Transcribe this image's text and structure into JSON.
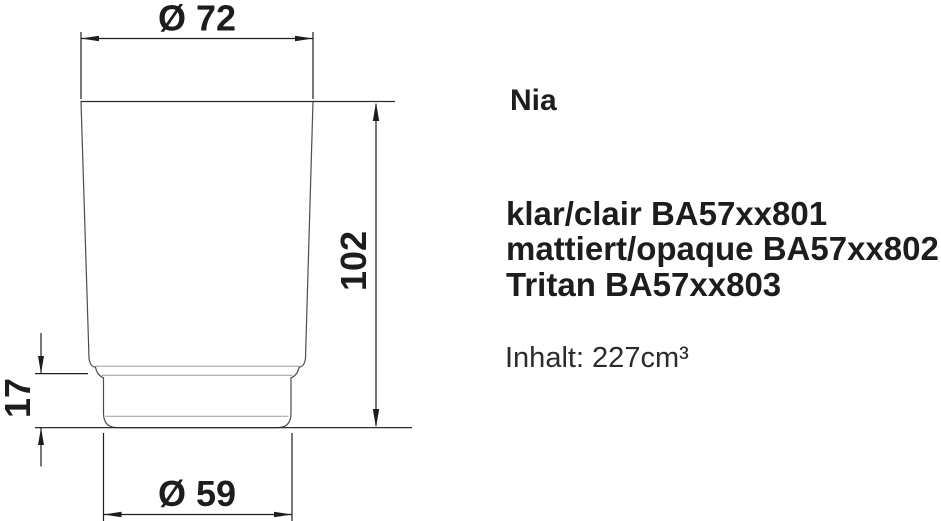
{
  "product": {
    "name": "Nia",
    "variants": [
      {
        "label": "klar/clair BA57xx801"
      },
      {
        "label": "mattiert/opaque BA57xx802"
      },
      {
        "label": "Tritan BA57xx803"
      }
    ],
    "capacity": "Inhalt: 227cm³"
  },
  "drawing": {
    "type": "technical-drawing",
    "subject": "tumbler-glass-side-profile",
    "dimensions": {
      "top_diameter": "Ø 72",
      "height": "102",
      "base_height": "17",
      "base_diameter": "Ø 59"
    }
  },
  "colors": {
    "ink": "#1d1d1b",
    "profile_gray": "#4d4d4d",
    "thin_line_gray": "#9a9a9a",
    "background": "#ffffff"
  }
}
